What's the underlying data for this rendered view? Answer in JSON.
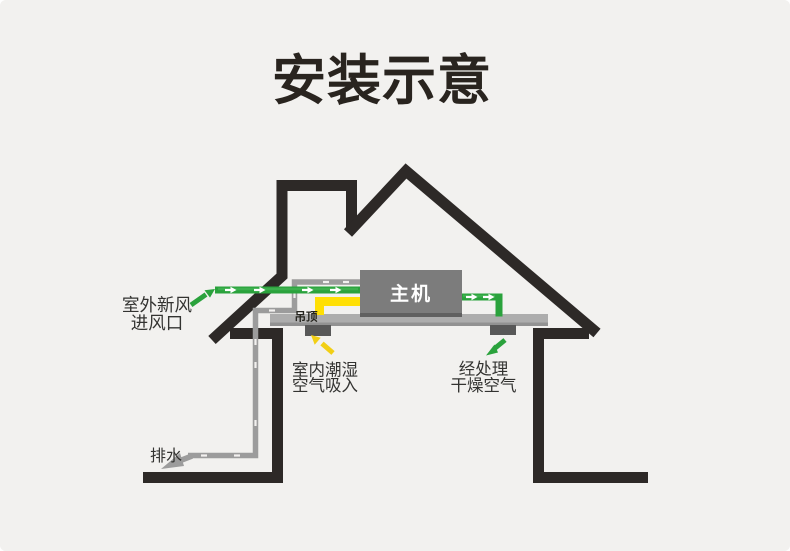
{
  "title": "安装示意",
  "labels": {
    "fresh_air_inlet": [
      "室外新风",
      "进风口"
    ],
    "ceiling": "吊顶",
    "main_unit": "主机",
    "humid_intake": [
      "室内潮湿",
      "空气吸入"
    ],
    "dry_air_out": [
      "经处理",
      "干燥空气"
    ],
    "drain": "排水"
  },
  "icons": {
    "fresh_air_arrow": "green-arrow-up-right",
    "dry_air_arrow": "green-arrow-down-left",
    "humid_air_arrow": "yellow-arrow-up-left",
    "drain_arrow": "gray-arrow-down-left",
    "duct_flow_marks": "white-right-arrows"
  },
  "colors": {
    "background": "#f2f1ef",
    "house_outline": "#2d2927",
    "fresh_air_green": "#2aa23c",
    "fresh_air_green_light": "#3db04e",
    "humid_air_yellow": "#ffdf04",
    "humid_arrow_yellow": "#f2cf15",
    "drain_pipe_gray": "#9c9c9c",
    "ceiling_slab_gray": "#adadad",
    "main_unit_gray": "#7c7c7c",
    "vent_gray": "#585858",
    "title_black": "#29241f"
  }
}
